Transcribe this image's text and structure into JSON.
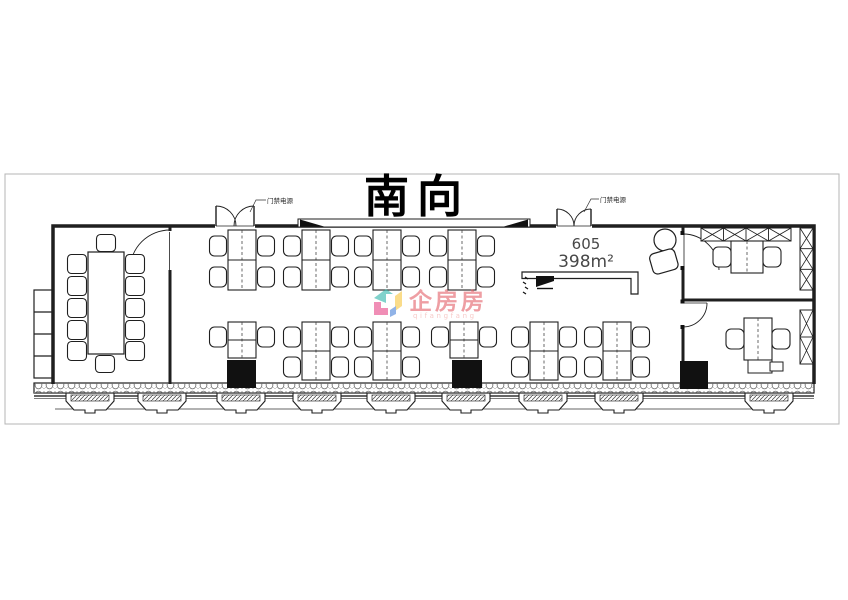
{
  "title": "南向",
  "unit": {
    "number": "605",
    "area": "398m²"
  },
  "doors": {
    "left_label": "门禁电源",
    "right_label": "门禁电源"
  },
  "watermark": {
    "brand": "企房房",
    "latin": "qifangfang"
  },
  "colors": {
    "wall": "#1f1f1f",
    "boundary": "#b5b5b5",
    "column": "#111111",
    "area_text": "#474747",
    "watermark_text": "#e4636c",
    "watermark_latin": "#f2a9a6",
    "logo_teal": "#35b8ad",
    "logo_yellow": "#f7c843",
    "logo_magenta": "#e84a8a",
    "logo_blue": "#4f86d9"
  },
  "rooms": {
    "conference_room": {
      "name": "conference room",
      "seats": 12,
      "table": "rectangular"
    },
    "open_office": {
      "top_row_clusters": 4,
      "bottom_row_clusters": 6,
      "workstation_seats": 36
    },
    "private_office_top": {
      "desks": 1,
      "chairs": 2,
      "cabinets": 2
    },
    "private_office_bottom": {
      "desks": 1,
      "chairs": 2,
      "cabinets": 1
    },
    "entrances": 2,
    "structural_columns": 3,
    "ac_platforms": 9
  }
}
